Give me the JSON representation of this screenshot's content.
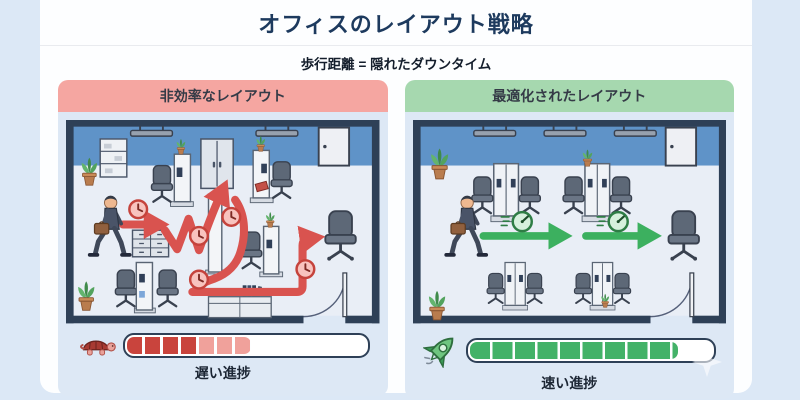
{
  "page": {
    "title": "オフィスのレイアウト戦略",
    "subtitle": "歩行距離 = 隠れたダウンタイム"
  },
  "panels": {
    "inefficient": {
      "header": "非効率なレイアウト",
      "header_color": "#f5a6a1",
      "path_color": "#d9534f",
      "marker_icon": "clock-icon",
      "marker_count": 5,
      "progress": {
        "icon": "turtle-icon",
        "label": "遅い進捗",
        "percent": 52,
        "segment_colors": [
          "#c9443d",
          "#f0a19b"
        ]
      }
    },
    "optimized": {
      "header": "最適化されたレイアウト",
      "header_color": "#a6d8af",
      "path_color": "#3cb05f",
      "marker_icon": "speedometer-icon",
      "marker_count": 2,
      "progress": {
        "icon": "rocket-icon",
        "label": "速い進捗",
        "percent": 86,
        "segment_colors": [
          "#43b268"
        ]
      }
    }
  },
  "scene_colors": {
    "wall": "#2e4057",
    "wall_band": "#5f93c8",
    "floor": "#e9eef6",
    "panel_bg": "#dde8f5"
  }
}
